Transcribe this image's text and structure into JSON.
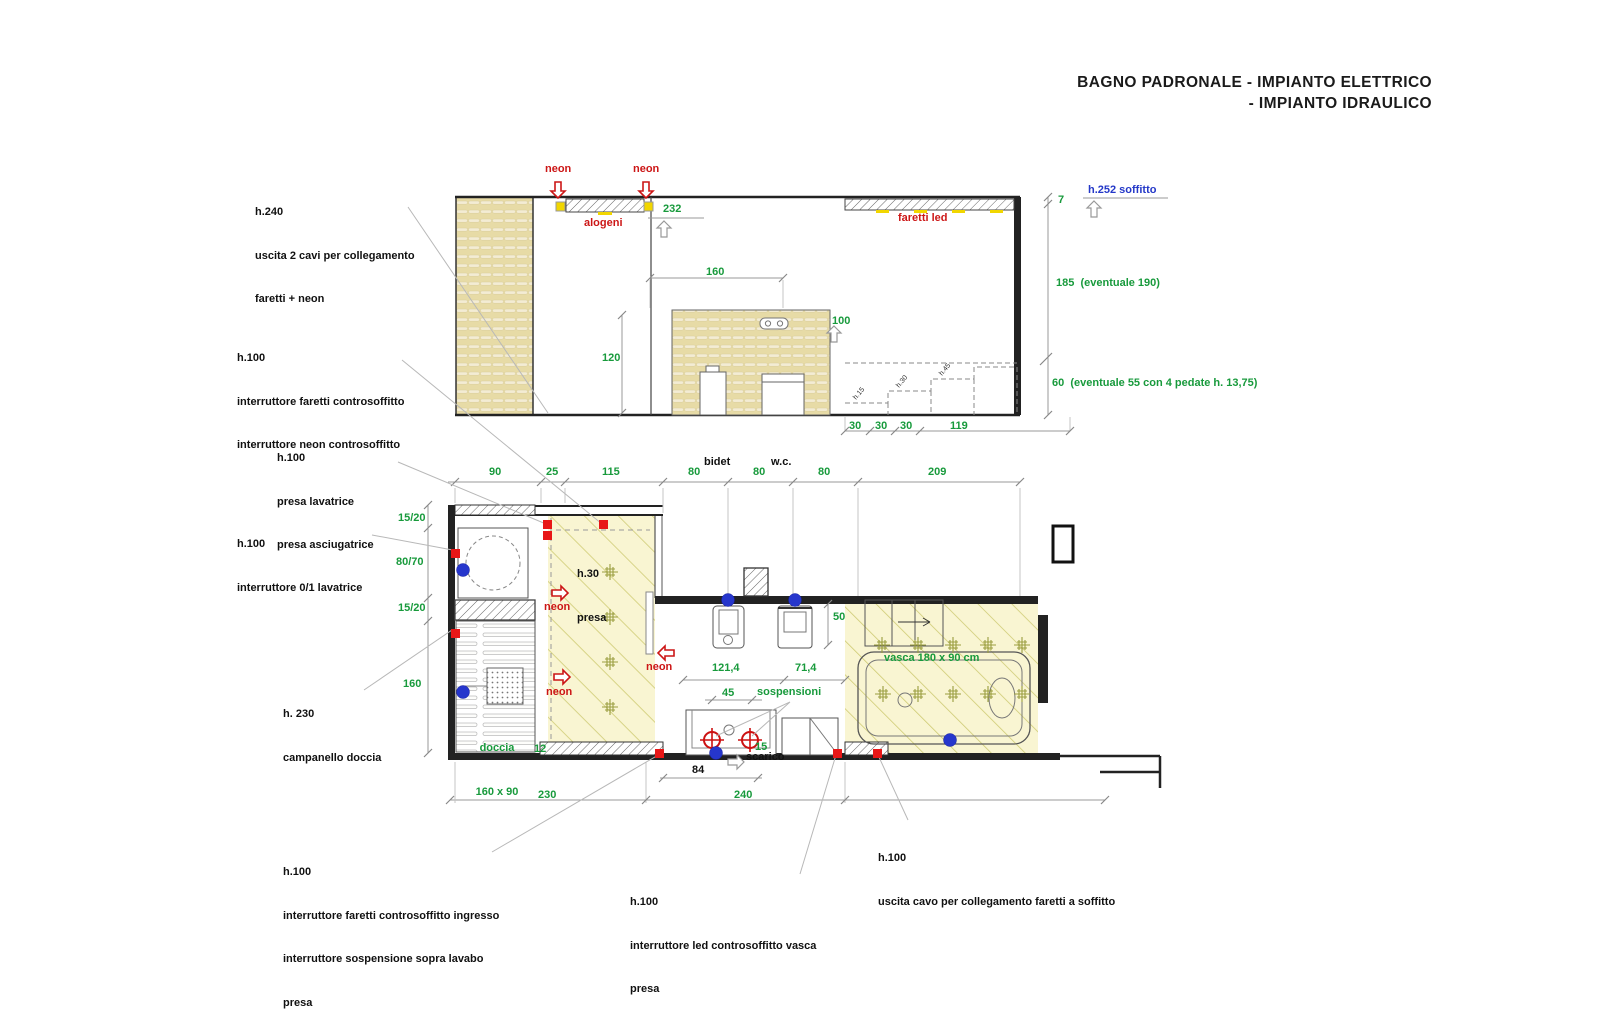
{
  "colors": {
    "dimension_green": "#189a3c",
    "electric_red": "#cc1616",
    "hydraulic_blue": "#2438c8",
    "wall_black": "#1c1c1c",
    "zone_yellow": "#f9f5d2",
    "panel_beige": "#e7dba6"
  },
  "title": {
    "line1": "BAGNO PADRONALE - IMPIANTO ELETTRICO",
    "line2": "- IMPIANTO IDRAULICO"
  },
  "section": {
    "neon_left": "neon",
    "neon_right": "neon",
    "alogeni": "alogeni",
    "faretti_led": "faretti led",
    "h252_soffitto": "h.252 soffitto",
    "dim_232": "232",
    "dim_160": "160",
    "dim_100": "100",
    "dim_120": "120",
    "dim_7": "7",
    "dim_185": "185  (eventuale 190)",
    "dim_60": "60  (eventuale 55 con 4 pedate h. 13,75)",
    "dim_30_1": "30",
    "dim_30_2": "30",
    "dim_30_3": "30",
    "dim_119": "119",
    "stairs": [
      "h.15",
      "h.30",
      "h.45"
    ]
  },
  "plan": {
    "top_dims": [
      "90",
      "25",
      "115",
      "80",
      "80",
      "80",
      "209"
    ],
    "bidet": "bidet",
    "wc": "w.c.",
    "left_dims": [
      "15/20",
      "80/70",
      "15/20",
      "160"
    ],
    "h30_presa": [
      "h.30",
      "presa"
    ],
    "neon_1": "neon",
    "neon_2": "neon",
    "neon_3": "neon",
    "doccia": [
      "doccia",
      "160 x 90"
    ],
    "vasca": "vasca 180 x 90 cm",
    "sospensioni": "sospensioni",
    "scarico": "scarico",
    "dim_12": "12",
    "dim_15": "15",
    "dim_50": "50",
    "dim_121": "121,4",
    "dim_71": "71,4",
    "dim_45": "45",
    "dim_84": "84",
    "dim_230": "230",
    "dim_240": "240"
  },
  "annotations": {
    "a1": [
      "h.240",
      "uscita 2 cavi per collegamento",
      "faretti + neon"
    ],
    "a2": [
      "h.100",
      "interruttore faretti controsoffitto",
      "interruttore neon controsoffitto"
    ],
    "a3": [
      "h.100",
      "presa lavatrice",
      "presa asciugatrice"
    ],
    "a4": [
      "h.100",
      "interruttore 0/1 lavatrice"
    ],
    "a5": [
      "h. 230",
      "campanello doccia"
    ],
    "b1": [
      "h.100",
      "interruttore faretti controsoffitto ingresso",
      "interruttore sospensione sopra lavabo",
      "presa"
    ],
    "b2": [
      "h.100",
      "interruttore led controsoffitto vasca",
      "presa"
    ],
    "b3": [
      "h.100",
      "uscita cavo per collegamento faretti a soffitto"
    ]
  }
}
